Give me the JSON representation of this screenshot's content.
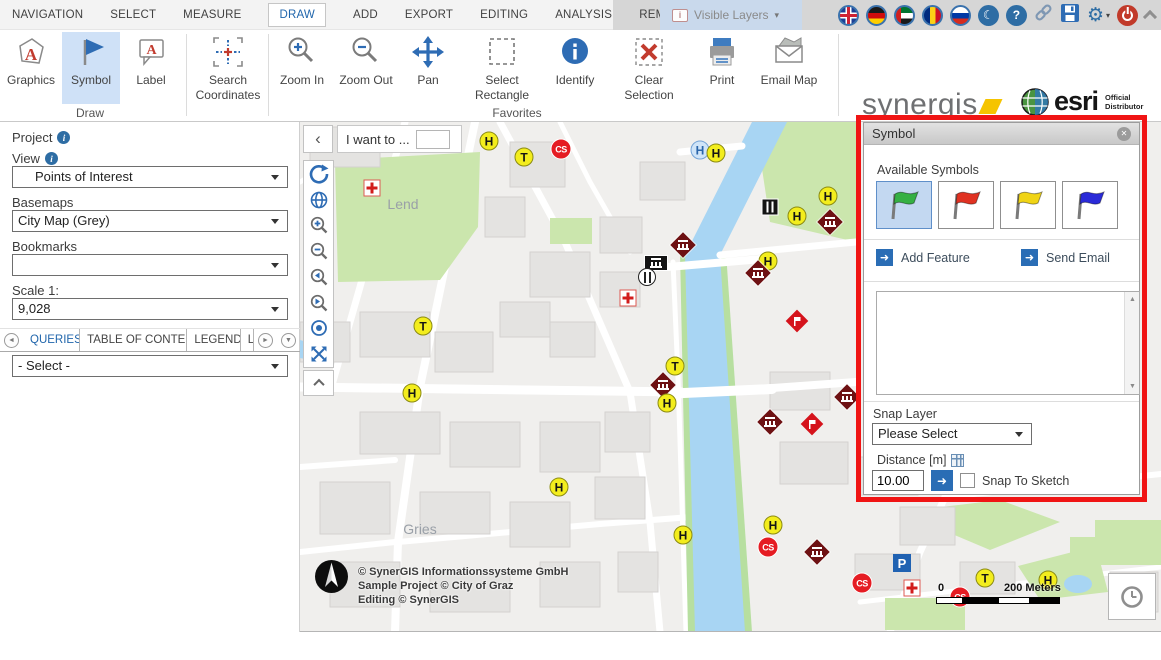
{
  "menubar": {
    "items": [
      "NAVIGATION",
      "SELECT",
      "MEASURE",
      "DRAW",
      "ADD",
      "EXPORT",
      "EDITING",
      "ANALYSIS",
      "REMAINING TOOLS"
    ],
    "active": "DRAW",
    "visible_layers": "Visible Layers"
  },
  "icons": {
    "help": "?",
    "crescent": "☾",
    "gear": "⚙",
    "dropdown_caret": "▾",
    "close": "✕",
    "scroll_up": "▲",
    "scroll_down": "▼",
    "tab_prev": "◄",
    "tab_next": "►",
    "tab_menu": "▼",
    "collapse_left": "‹",
    "arrow_right": "➜"
  },
  "ribbon": {
    "buttons": [
      {
        "label": "Graphics"
      },
      {
        "label": "Symbol",
        "selected": true
      },
      {
        "label": "Label"
      },
      {
        "label": "Search Coordinates"
      },
      {
        "label": "Zoom In"
      },
      {
        "label": "Zoom Out"
      },
      {
        "label": "Pan"
      },
      {
        "label": "Select Rectangle"
      },
      {
        "label": "Identify"
      },
      {
        "label": "Clear Selection"
      },
      {
        "label": "Print"
      },
      {
        "label": "Email Map"
      }
    ],
    "groups": {
      "draw": "Draw",
      "favorites": "Favorites"
    },
    "brand": {
      "synergis": "synergis",
      "esri": "esri",
      "esri_tagline_1": "Official",
      "esri_tagline_2": "Distributor"
    }
  },
  "sidebar": {
    "project_label": "Project",
    "view_label": "View",
    "view_value": "Points of Interest",
    "basemaps_label": "Basemaps",
    "basemaps_value": "City Map (Grey)",
    "bookmarks_label": "Bookmarks",
    "bookmarks_value": "",
    "scale_label": "Scale 1:",
    "scale_value": "9,028",
    "tabs": [
      "QUERIES",
      "TABLE OF CONTENT",
      "LEGEND",
      "L"
    ],
    "active_tab": "QUERIES",
    "query_select_value": "- Select -"
  },
  "map": {
    "i_want_to": "I want to ...",
    "place_labels": [
      {
        "text": "Lend",
        "x": 103,
        "y": 82
      },
      {
        "text": "Gries",
        "x": 120,
        "y": 407
      }
    ],
    "attribution": [
      "© SynerGIS Informationssysteme GmbH",
      "Sample Project © City of Graz",
      "Editing © SynerGIS"
    ],
    "scalebar": {
      "start": "0",
      "end": "200 Meters"
    },
    "markers": [
      {
        "type": "stop-h",
        "letter": "H",
        "x": 189,
        "y": 19
      },
      {
        "type": "stop-t",
        "letter": "T",
        "x": 224,
        "y": 35
      },
      {
        "type": "cs",
        "letter": "CS",
        "x": 261,
        "y": 27
      },
      {
        "type": "stop-h-blue",
        "letter": "H",
        "x": 400,
        "y": 28
      },
      {
        "type": "stop-h",
        "letter": "H",
        "x": 416,
        "y": 31
      },
      {
        "type": "pharmacy",
        "x": 72,
        "y": 66
      },
      {
        "type": "restaurant-dark",
        "x": 470,
        "y": 85
      },
      {
        "type": "stop-h",
        "letter": "H",
        "x": 497,
        "y": 94
      },
      {
        "type": "stop-h",
        "letter": "H",
        "x": 528,
        "y": 74
      },
      {
        "type": "museum",
        "x": 530,
        "y": 100
      },
      {
        "type": "museum",
        "x": 383,
        "y": 123
      },
      {
        "type": "theater",
        "x": 356,
        "y": 141
      },
      {
        "type": "restaurant-light",
        "x": 347,
        "y": 155
      },
      {
        "type": "pharmacy",
        "x": 328,
        "y": 176
      },
      {
        "type": "stop-h",
        "letter": "H",
        "x": 468,
        "y": 139
      },
      {
        "type": "museum",
        "x": 458,
        "y": 151
      },
      {
        "type": "stop-t",
        "letter": "T",
        "x": 123,
        "y": 204
      },
      {
        "type": "sight",
        "x": 497,
        "y": 199
      },
      {
        "type": "stop-t",
        "letter": "T",
        "x": 375,
        "y": 244
      },
      {
        "type": "museum",
        "x": 363,
        "y": 263
      },
      {
        "type": "stop-h",
        "letter": "H",
        "x": 367,
        "y": 281
      },
      {
        "type": "stop-h",
        "letter": "H",
        "x": 112,
        "y": 271
      },
      {
        "type": "museum",
        "x": 470,
        "y": 300
      },
      {
        "type": "museum",
        "x": 547,
        "y": 275
      },
      {
        "type": "sight",
        "x": 512,
        "y": 302
      },
      {
        "type": "stop-h",
        "letter": "H",
        "x": 259,
        "y": 365
      },
      {
        "type": "stop-h",
        "letter": "H",
        "x": 383,
        "y": 413
      },
      {
        "type": "stop-h",
        "letter": "H",
        "x": 473,
        "y": 403
      },
      {
        "type": "cs",
        "letter": "CS",
        "x": 468,
        "y": 425
      },
      {
        "type": "museum",
        "x": 517,
        "y": 430
      },
      {
        "type": "parking",
        "letter": "P",
        "x": 602,
        "y": 441
      },
      {
        "type": "cs",
        "letter": "CS",
        "x": 562,
        "y": 461
      },
      {
        "type": "pharmacy",
        "x": 612,
        "y": 466
      },
      {
        "type": "stop-t",
        "letter": "T",
        "x": 685,
        "y": 456
      },
      {
        "type": "stop-h",
        "letter": "H",
        "x": 748,
        "y": 458
      },
      {
        "type": "cs",
        "letter": "CS",
        "x": 660,
        "y": 475
      }
    ]
  },
  "symbol_panel": {
    "title": "Symbol",
    "available_symbols_label": "Available Symbols",
    "symbols": [
      {
        "name": "green-flag",
        "color": "#35b043",
        "selected": true
      },
      {
        "name": "red-flag",
        "color": "#e03222",
        "selected": false
      },
      {
        "name": "yellow-flag",
        "color": "#f0d416",
        "selected": false
      },
      {
        "name": "blue-flag",
        "color": "#2a2ad8",
        "selected": false
      }
    ],
    "add_feature_label": "Add Feature",
    "send_email_label": "Send Email",
    "snap_layer_label": "Snap Layer",
    "snap_layer_value": "Please Select",
    "distance_label": "Distance [m]",
    "distance_value": "10.00",
    "snap_to_sketch_label": "Snap To Sketch"
  },
  "colors": {
    "accent_blue": "#2a6db5",
    "active_text_blue": "#2166ac",
    "highlight_red": "#f01414",
    "marker_yellow": "#f3ed1d",
    "marker_darkred": "#6e1113",
    "marker_red": "#e51c23",
    "river_blue": "#a8d5f3",
    "park_green": "#cbe6ad"
  }
}
